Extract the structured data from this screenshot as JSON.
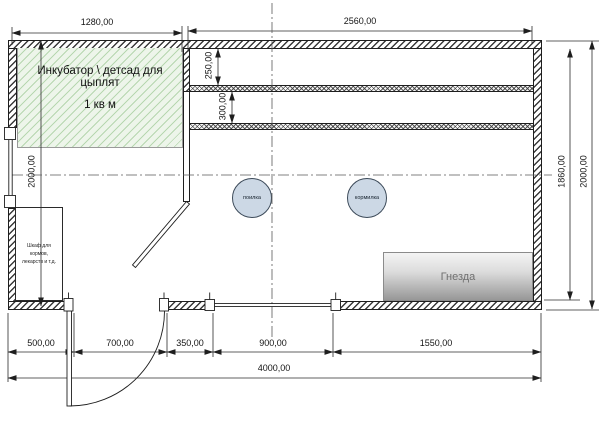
{
  "plan": {
    "incubator": {
      "title": "Инкубатор \\ детсад для цыплят",
      "area": "1 кв м"
    },
    "cabinet": {
      "label": "Шкаф для\nкормов,\nлекарств и т.д."
    },
    "fixtures": {
      "drinker": "поилка",
      "feeder": "кормилка",
      "nests": "Гнезда"
    }
  },
  "dimensions": {
    "top": [
      "1280,00",
      "2560,00"
    ],
    "left_height": "2000,00",
    "right_inner_height": "1860,00",
    "right_outer_height": "2000,00",
    "roost_offset": "250,00",
    "roost_spacing": "300,00",
    "bottom_segments": [
      "500,00",
      "700,00",
      "350,00",
      "900,00",
      "1550,00"
    ],
    "total_width": "4000,00"
  },
  "colors": {
    "incubator_fill": "#edf5ea",
    "incubator_hatch": "#b7d7b0",
    "fixture_circle_fill": "#ccd8e5",
    "nests_gradient_top": "#f4f4f4",
    "nests_gradient_bottom": "#979797",
    "line": "#1e1e1e"
  }
}
